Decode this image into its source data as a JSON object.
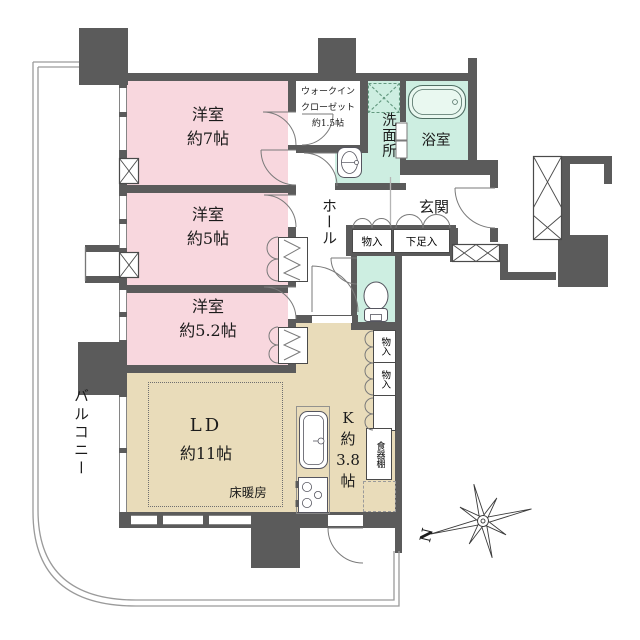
{
  "floorplan": {
    "rooms": {
      "bedroom1": {
        "name": "洋室",
        "size": "約7帖"
      },
      "bedroom2": {
        "name": "洋室",
        "size": "約5帖"
      },
      "bedroom3": {
        "name": "洋室",
        "size": "約5.2帖"
      },
      "living_dining": {
        "name": "LD",
        "size": "約11帖",
        "floor_heating": "床暖房"
      },
      "kitchen": {
        "lines": [
          "K",
          "約",
          "3.8",
          "帖"
        ]
      },
      "walk_in_closet": {
        "lines": [
          "ウォークイン",
          "クローゼット",
          "約1.5帖"
        ]
      },
      "washroom": {
        "name": "洗面所"
      },
      "bathroom": {
        "name": "浴室"
      },
      "entrance": {
        "name": "玄関"
      },
      "hall": {
        "name": "ホール"
      },
      "balcony": {
        "name": "バルコニー"
      }
    },
    "storage": {
      "hall_closet": "物入",
      "shoe_cabinet": "下足入",
      "kitchen_closet_upper": "物入",
      "kitchen_closet_lower": "物入",
      "cupboard": "食器棚"
    },
    "compass": {
      "north_label": "N"
    },
    "icons": [
      "bathtub-icon",
      "toilet-icon",
      "washbasin-icon",
      "kitchen-sink-icon",
      "stove-icon",
      "washer-pan-icon",
      "compass-rose-icon",
      "hanger-rod-icon"
    ],
    "colors": {
      "wall": "#5b5b5b",
      "bedroom_fill": "#f8d7de",
      "wet_area_fill": "#cdeee1",
      "living_fill": "#e9dcba"
    }
  }
}
